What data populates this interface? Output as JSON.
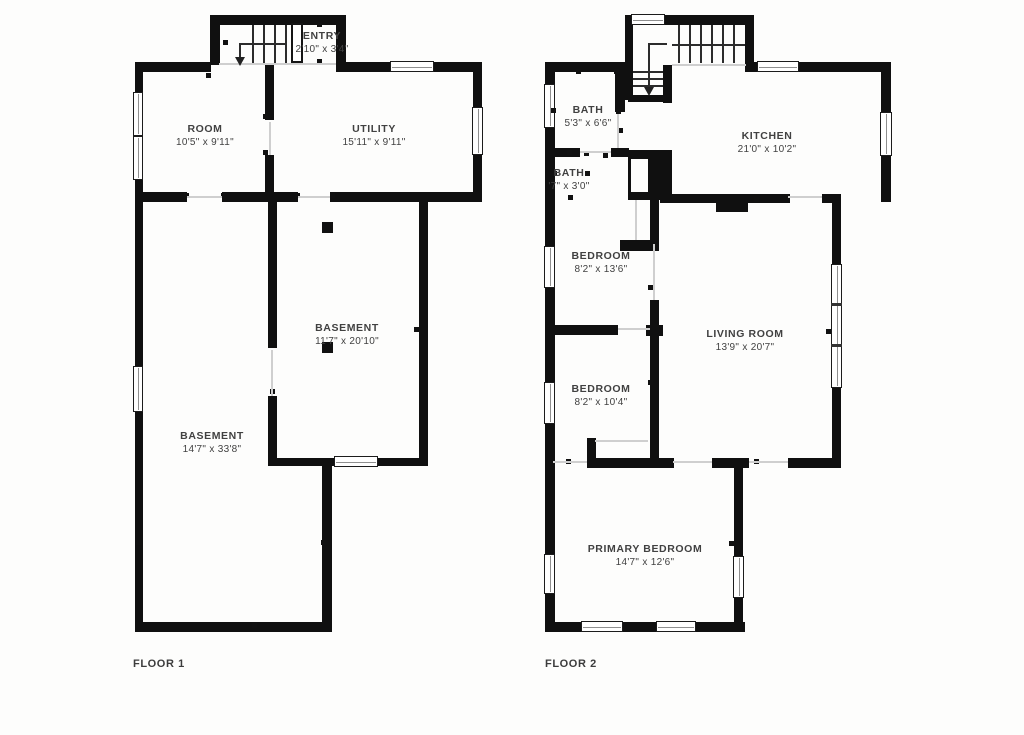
{
  "colors": {
    "wall": "#101010",
    "text": "#414141",
    "background": "#fdfdfc",
    "opening_line": "#cfcfcf"
  },
  "floor1": {
    "label": "FLOOR 1",
    "rooms": {
      "entry": {
        "name": "ENTRY",
        "dims": "2'10\" x 3'4\""
      },
      "room": {
        "name": "ROOM",
        "dims": "10'5\" x 9'11\""
      },
      "utility": {
        "name": "UTILITY",
        "dims": "15'11\" x 9'11\""
      },
      "basement_inner": {
        "name": "BASEMENT",
        "dims": "11'7\" x 20'10\""
      },
      "basement_main": {
        "name": "BASEMENT",
        "dims": "14'7\" x 33'8\""
      }
    }
  },
  "floor2": {
    "label": "FLOOR 2",
    "rooms": {
      "bath_upper": {
        "name": "BATH",
        "dims": "5'3\" x 6'6\""
      },
      "bath_lower": {
        "name": "BATH",
        "dims": "'7\" x 3'0\""
      },
      "kitchen": {
        "name": "KITCHEN",
        "dims": "21'0\" x 10'2\""
      },
      "bedroom_upper": {
        "name": "BEDROOM",
        "dims": "8'2\" x 13'6\""
      },
      "living_room": {
        "name": "LIVING ROOM",
        "dims": "13'9\" x 20'7\""
      },
      "bedroom_lower": {
        "name": "BEDROOM",
        "dims": "8'2\" x 10'4\""
      },
      "primary_bedroom": {
        "name": "PRIMARY BEDROOM",
        "dims": "14'7\" x 12'6\""
      }
    }
  }
}
